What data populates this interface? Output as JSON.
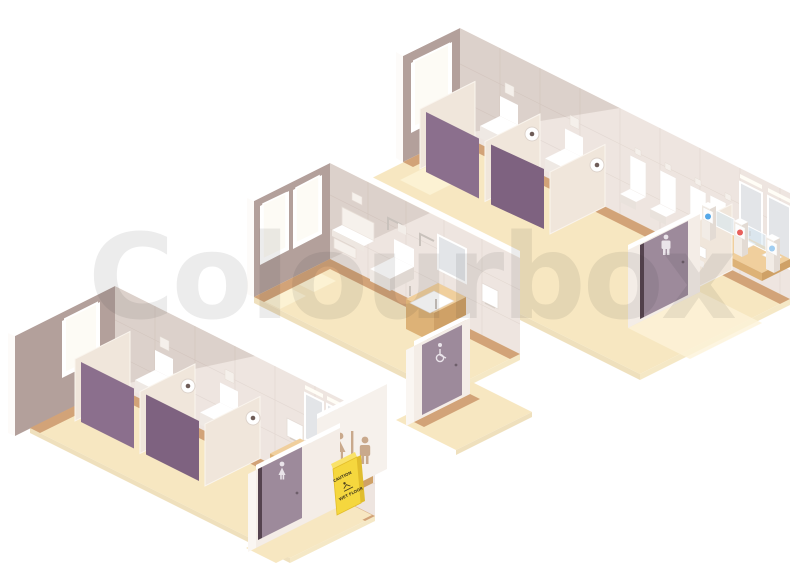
{
  "watermark": {
    "text": "Colourbox"
  },
  "caution_sign": {
    "line1": "CAUTION",
    "line2": "WET FLOOR"
  },
  "illustration": {
    "style": "isometric vector illustration",
    "scene": "three public restroom interiors on white background",
    "rooms": [
      {
        "name": "women's restroom",
        "door_icon": "female",
        "exterior_sign": "women-and-men pictograms",
        "fixtures": [
          "toilet stalls with purple doors",
          "toilet paper rolls",
          "hand dryer",
          "three sinks with mirrors",
          "window",
          "wet floor caution sign"
        ]
      },
      {
        "name": "accessible restroom",
        "door_icon": "wheelchair",
        "fixtures": [
          "baby changing table",
          "toilet with grab bars",
          "sink with grab bars and mirror",
          "hand dryer",
          "two windows"
        ]
      },
      {
        "name": "men's restroom",
        "door_icon": "male",
        "fixtures": [
          "toilet stalls with purple doors",
          "four urinals",
          "two sinks with mirrors",
          "window",
          "entrance turnstile gates with blue and red indicators"
        ]
      }
    ]
  },
  "icons": [
    "female-icon",
    "male-icon",
    "wheelchair-icon",
    "slip-hazard-icon",
    "toilet-paper-roll"
  ],
  "colors": {
    "background": "#ffffff",
    "floor": "#f7e7c1",
    "floor_edge": "#efe0bd",
    "floor_highlight": "#fdf3d6",
    "wood_trim": "#d2a378",
    "wall_lit": "#eee5e0",
    "wall_tile_line": "#e3d8d2",
    "wall_shadow": "#b3a09b",
    "stall_partition": "#f0e6db",
    "stall_door_purple": "#8b6f8d",
    "entrance_door_mauve": "#9d8a9b",
    "fixture_white": "#ffffff",
    "counter_tan": "#f0cf9d",
    "mirror_gray": "#e3e5e8",
    "caution_yellow": "#f5d73e",
    "gate_indicator_blue": "#56a8e8",
    "gate_indicator_red": "#e8605c",
    "sign_tan": "#c9a98c"
  }
}
